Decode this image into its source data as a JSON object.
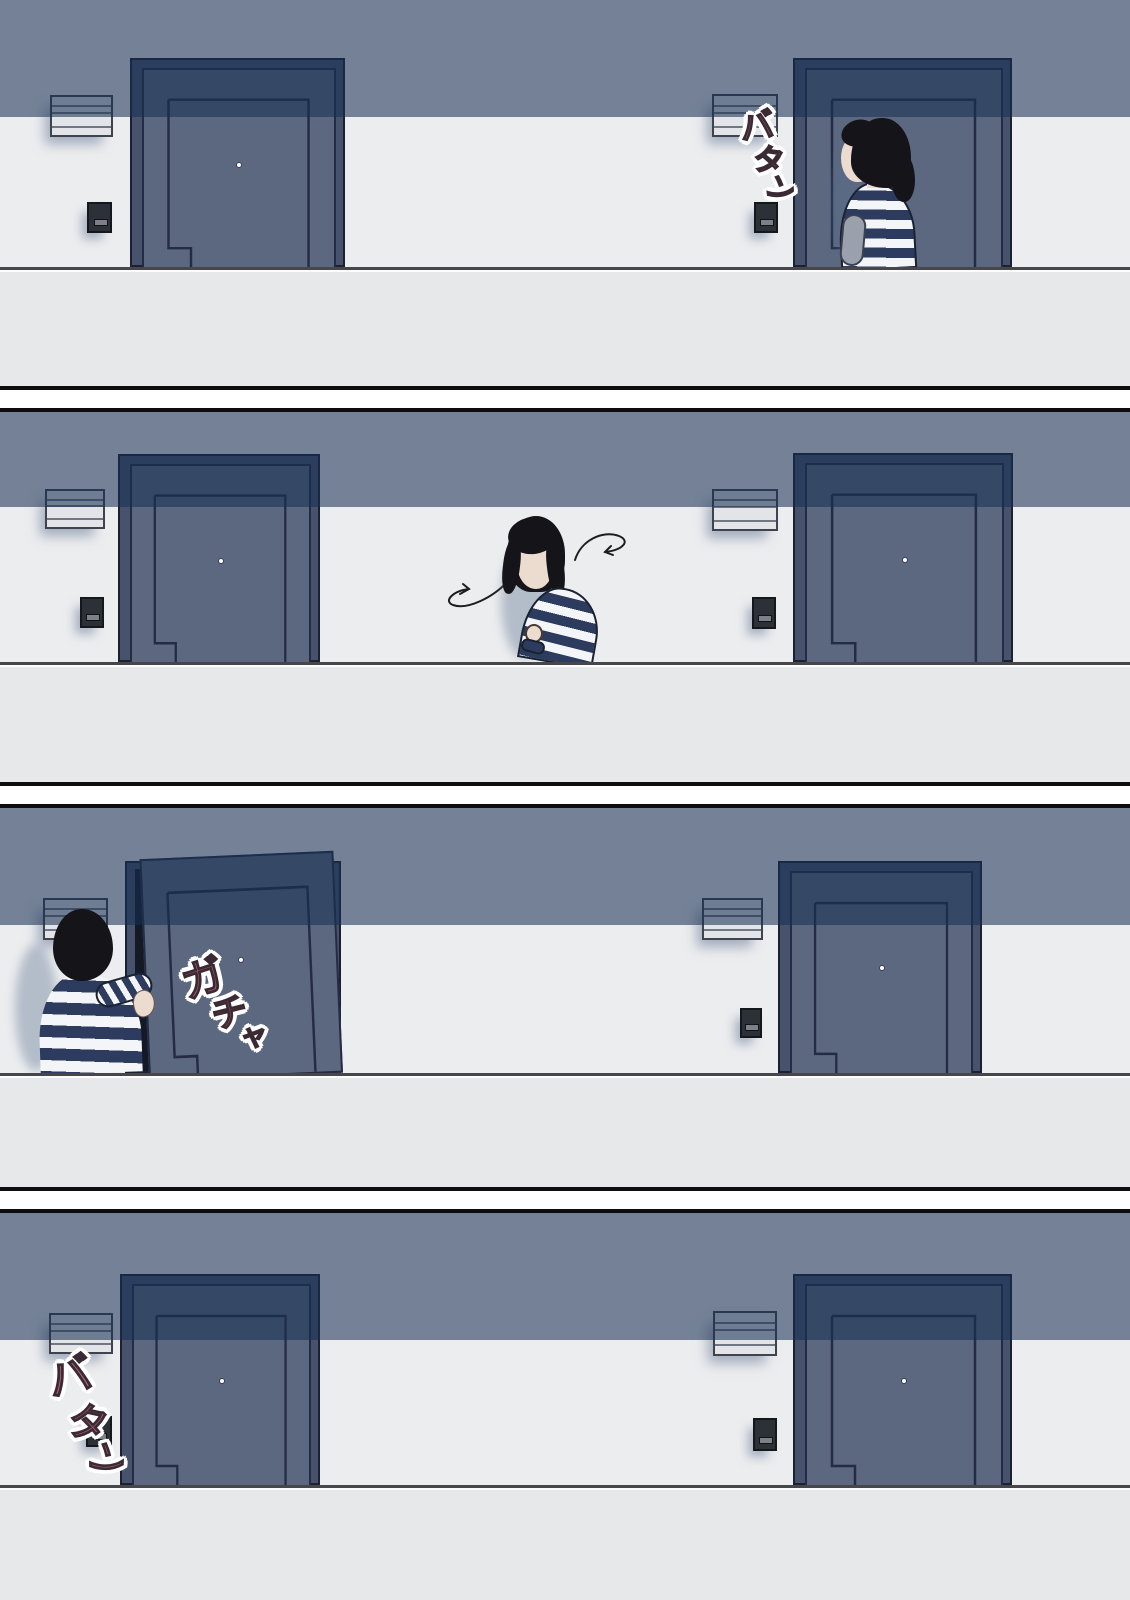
{
  "colors": {
    "wall-shadow-overlay": "rgba(24,48,82,0.57)",
    "wall-lit": "#ecedef",
    "walkband": "#e7e8ea",
    "walkline": "#47474b",
    "door-frame": "#47526c",
    "door-slab": "#5c6880",
    "door-opening": "#141926",
    "door-line": "#232c44",
    "outline": "#1a2232",
    "mailbox": "#e2e4e7",
    "intercom": "#2c3037",
    "hair": "#141419",
    "skin": "#ecdccf",
    "stripe-navy": "#2c3b5e",
    "stripe-white": "#f3f5f8",
    "sfx-pink": "#c4687e",
    "sfx-dark": "#3b2a33",
    "gutter": "#ffffff",
    "border": "#0d0d0d"
  },
  "panels": [
    {
      "name": "panel-1",
      "scene": "woman in striped shirt at the right apartment door as it shuts",
      "sfx": {
        "text": "バタン",
        "chars": [
          "バ",
          "タ",
          "ン"
        ]
      }
    },
    {
      "name": "panel-2",
      "scene": "woman pauses between the two doors looking around",
      "sfx": null
    },
    {
      "name": "panel-3",
      "scene": "woman opens the left apartment door",
      "sfx": {
        "text": "ガチャ",
        "chars": [
          "ガ",
          "チ",
          "ャ"
        ]
      }
    },
    {
      "name": "panel-4",
      "scene": "both doors closed, slam heard at the left door",
      "sfx": {
        "text": "バタン",
        "chars": [
          "バ",
          "タ",
          "ン"
        ]
      }
    }
  ]
}
